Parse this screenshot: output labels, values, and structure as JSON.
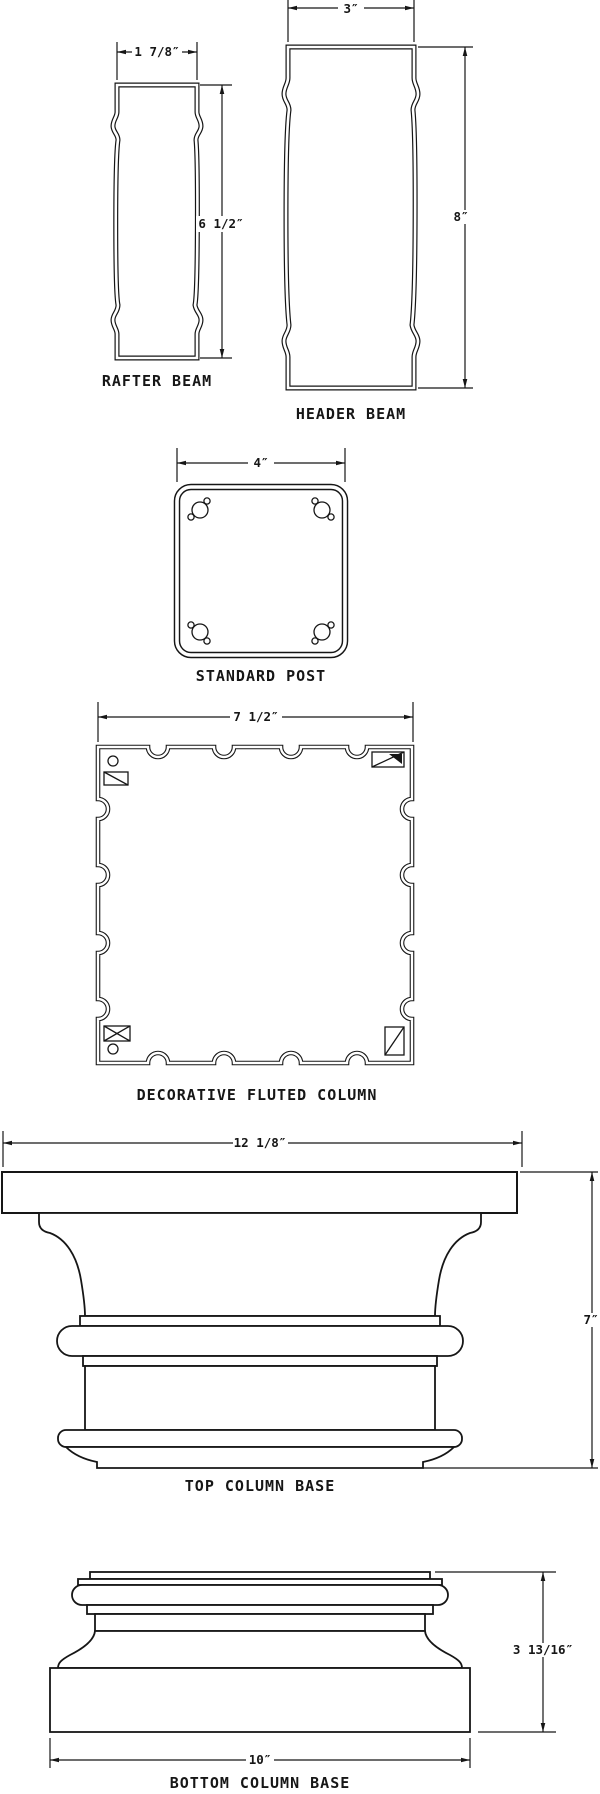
{
  "title": "Structural components cross-section drawing",
  "colors": {
    "background": "#ffffff",
    "line": "#161616"
  },
  "rafter_beam": {
    "label": "RAFTER BEAM",
    "width_dim": "1 7/8″",
    "height_dim": "6 1/2″"
  },
  "header_beam": {
    "label": "HEADER BEAM",
    "width_dim": "3″",
    "height_dim": "8″"
  },
  "standard_post": {
    "label": "STANDARD POST",
    "width_dim": "4″"
  },
  "fluted_column": {
    "label": "DECORATIVE FLUTED COLUMN",
    "width_dim": "7 1/2″"
  },
  "top_column_base": {
    "label": "TOP COLUMN BASE",
    "width_dim": "12 1/8″",
    "height_dim": "7″"
  },
  "bottom_column_base": {
    "label": "BOTTOM COLUMN BASE",
    "width_dim": "10″",
    "height_dim": "3 13/16″"
  }
}
